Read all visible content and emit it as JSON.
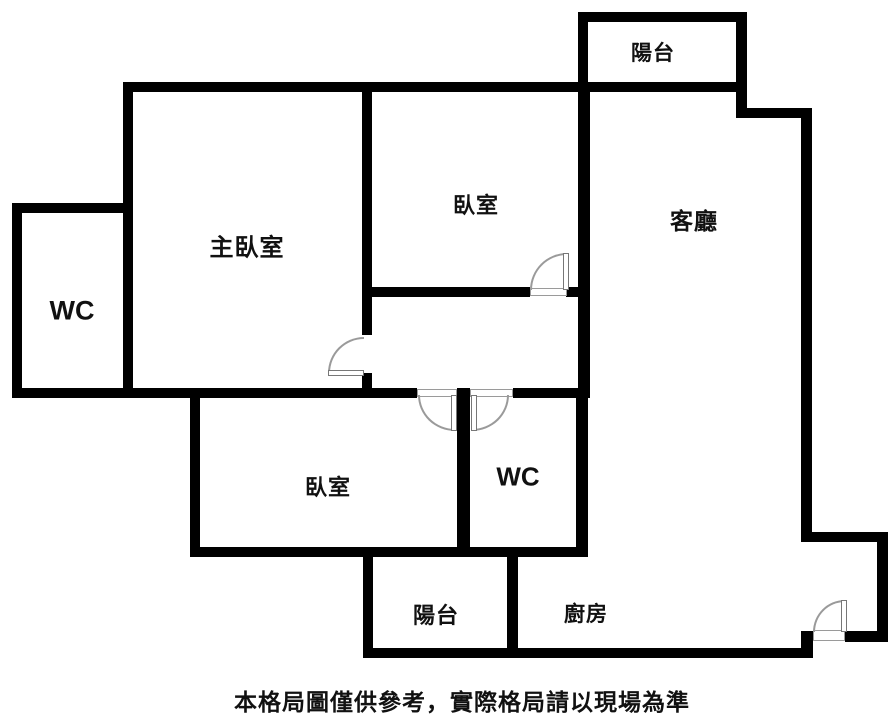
{
  "floorplan": {
    "rooms": {
      "master_bedroom": {
        "label": "主臥室"
      },
      "bedroom_top": {
        "label": "臥室"
      },
      "living_room": {
        "label": "客廳"
      },
      "balcony_top": {
        "label": "陽台"
      },
      "wc_left": {
        "label": "WC"
      },
      "bedroom_bottom": {
        "label": "臥室"
      },
      "wc_bottom": {
        "label": "WC"
      },
      "balcony_bottom": {
        "label": "陽台"
      },
      "kitchen": {
        "label": "廚房"
      }
    },
    "disclaimer": "本格局圖僅供參考，實際格局請以現場為準",
    "colors": {
      "wall": "#000000",
      "door_arc": "#9a9a9a",
      "text": "#111111",
      "background": "#ffffff"
    }
  }
}
